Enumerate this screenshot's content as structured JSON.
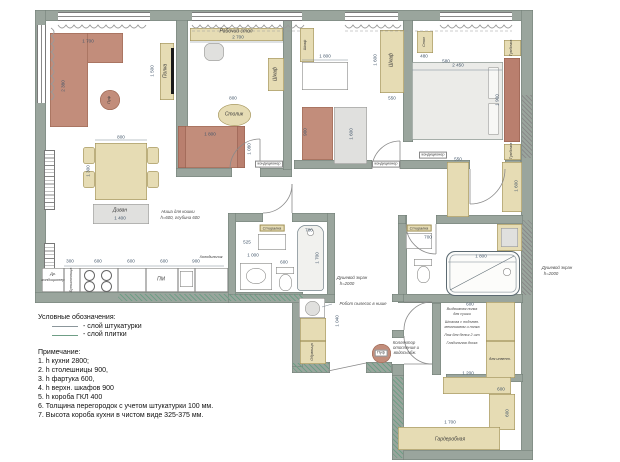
{
  "legend": {
    "title": "Условные обозначения:",
    "items": [
      {
        "swatch": "plaster",
        "label": "- слой штукатурки"
      },
      {
        "swatch": "tile",
        "label": "- слой плитки"
      }
    ]
  },
  "notes": {
    "title": "Примечание:",
    "items": [
      "1. h кухни 2800;",
      "2. h столешницы 900,",
      "3. h фартука 600,",
      "4. h верхн. шкафов 900",
      "5. h короба ГКЛ 400",
      "6. Толщина перегородок с учетом штукатурки 100 мм.",
      "7. Высота короба кухни в чистом виде 325-375 мм."
    ]
  },
  "colors": {
    "wall": "#9aa59d",
    "accent_red": "#c28d7b",
    "furniture_beige": "#e6dcb4",
    "tile_hatch": "#6f9e86"
  },
  "plan": {
    "labels": [
      {
        "text": "Рабочий стол",
        "x": 236,
        "y": 32,
        "cls": "name"
      },
      {
        "text": "2 700",
        "x": 238,
        "y": 38,
        "cls": "dim"
      },
      {
        "text": "Полка",
        "x": 166,
        "y": 71,
        "rot": 1,
        "cls": "name"
      },
      {
        "text": "1 500",
        "x": 153,
        "y": 71,
        "rot": 1,
        "cls": "dim"
      },
      {
        "text": "Шкаф",
        "x": 276,
        "y": 74,
        "rot": 1,
        "cls": "name"
      },
      {
        "text": "1 080",
        "x": 250,
        "y": 149,
        "rot": 1,
        "cls": "dim"
      },
      {
        "text": "Столик",
        "x": 234,
        "y": 115,
        "cls": "name"
      },
      {
        "text": "800",
        "x": 233,
        "y": 99,
        "cls": "dim"
      },
      {
        "text": "1 800",
        "x": 210,
        "y": 135,
        "cls": "dim"
      },
      {
        "text": "1 700",
        "x": 88,
        "y": 42,
        "cls": "dim"
      },
      {
        "text": "2 380",
        "x": 64,
        "y": 86,
        "rot": 1,
        "cls": "dim"
      },
      {
        "text": "Пуф",
        "x": 110,
        "y": 100,
        "rot": 1,
        "cls": "name4"
      },
      {
        "text": "800",
        "x": 121,
        "y": 138,
        "cls": "dim"
      },
      {
        "text": "1 300",
        "x": 89,
        "y": 171,
        "rot": 1,
        "cls": "dim"
      },
      {
        "text": "Диван",
        "x": 120,
        "y": 211,
        "cls": "name"
      },
      {
        "text": "1 400",
        "x": 120,
        "y": 219,
        "cls": "dim"
      },
      {
        "text": "Ниша для кошки",
        "x": 178,
        "y": 212,
        "cls": "note"
      },
      {
        "text": "h=600, глубина 600",
        "x": 180,
        "y": 218,
        "cls": "note"
      },
      {
        "text": "Др.",
        "x": 53,
        "y": 275,
        "cls": "name4"
      },
      {
        "text": "кондиционер",
        "x": 53,
        "y": 281,
        "cls": "name4"
      },
      {
        "text": "Бутылочница",
        "x": 72,
        "y": 280,
        "rot": 1,
        "cls": "name4"
      },
      {
        "text": "ПМ",
        "x": 161,
        "y": 280,
        "cls": "name"
      },
      {
        "text": "Холодильник",
        "x": 211,
        "y": 258,
        "cls": "name4"
      },
      {
        "text": "300",
        "x": 70,
        "y": 262,
        "cls": "dim"
      },
      {
        "text": "600",
        "x": 98,
        "y": 262,
        "cls": "dim"
      },
      {
        "text": "600",
        "x": 131,
        "y": 262,
        "cls": "dim"
      },
      {
        "text": "600",
        "x": 164,
        "y": 262,
        "cls": "dim"
      },
      {
        "text": "900",
        "x": 196,
        "y": 262,
        "cls": "dim"
      },
      {
        "text": "Шкаф",
        "x": 306,
        "y": 45,
        "rot": 1,
        "cls": "name4"
      },
      {
        "text": "1 800",
        "x": 325,
        "y": 57,
        "cls": "dim"
      },
      {
        "text": "900",
        "x": 306,
        "y": 132,
        "rot": 1,
        "cls": "dim"
      },
      {
        "text": "1 600",
        "x": 352,
        "y": 134,
        "rot": 1,
        "cls": "dim"
      },
      {
        "text": "Шкаф",
        "x": 392,
        "y": 60,
        "rot": 1,
        "cls": "name"
      },
      {
        "text": "1 600",
        "x": 376,
        "y": 60,
        "rot": 1,
        "cls": "dim"
      },
      {
        "text": "550",
        "x": 392,
        "y": 99,
        "cls": "dim"
      },
      {
        "text": "Стол",
        "x": 425,
        "y": 42,
        "rot": 1,
        "cls": "name4"
      },
      {
        "text": "480",
        "x": 424,
        "y": 57,
        "cls": "dim"
      },
      {
        "text": "580",
        "x": 446,
        "y": 62,
        "cls": "dim"
      },
      {
        "text": "2 450",
        "x": 458,
        "y": 66,
        "cls": "dim"
      },
      {
        "text": "1 900",
        "x": 498,
        "y": 100,
        "rot": 1,
        "cls": "dim"
      },
      {
        "text": "Тумбочка",
        "x": 512,
        "y": 48,
        "rot": 1,
        "cls": "name4"
      },
      {
        "text": "Тумбочка",
        "x": 512,
        "y": 151,
        "rot": 1,
        "cls": "name4"
      },
      {
        "text": "кондиционер",
        "x": 269,
        "y": 164,
        "cls": "box"
      },
      {
        "text": "кондиционер",
        "x": 386,
        "y": 164,
        "cls": "box"
      },
      {
        "text": "кондиционер",
        "x": 433,
        "y": 155,
        "cls": "box"
      },
      {
        "text": "550",
        "x": 458,
        "y": 160,
        "cls": "dim"
      },
      {
        "text": "1 600",
        "x": 517,
        "y": 186,
        "rot": 1,
        "cls": "dim"
      },
      {
        "text": "Стиралка",
        "x": 272,
        "y": 228,
        "cls": "namebox"
      },
      {
        "text": "525",
        "x": 247,
        "y": 243,
        "cls": "dim"
      },
      {
        "text": "1 000",
        "x": 253,
        "y": 256,
        "cls": "dim"
      },
      {
        "text": "600",
        "x": 284,
        "y": 263,
        "cls": "dim"
      },
      {
        "text": "700",
        "x": 309,
        "y": 231,
        "cls": "dim"
      },
      {
        "text": "1 700",
        "x": 318,
        "y": 258,
        "rot": 1,
        "cls": "dim"
      },
      {
        "text": "Душевой экран",
        "x": 352,
        "y": 278,
        "cls": "note"
      },
      {
        "text": "h=2000",
        "x": 347,
        "y": 284,
        "cls": "note"
      },
      {
        "text": "Стиралка",
        "x": 419,
        "y": 228,
        "cls": "namebox"
      },
      {
        "text": "700",
        "x": 428,
        "y": 238,
        "cls": "dim"
      },
      {
        "text": "1 800",
        "x": 481,
        "y": 257,
        "cls": "dim"
      },
      {
        "text": "Душевой экран",
        "x": 557,
        "y": 268,
        "cls": "note"
      },
      {
        "text": "h=2000",
        "x": 551,
        "y": 274,
        "cls": "note"
      },
      {
        "text": "Робот пылесос в нише",
        "x": 363,
        "y": 304,
        "cls": "note"
      },
      {
        "text": "1 040",
        "x": 338,
        "y": 321,
        "rot": 1,
        "cls": "dim"
      },
      {
        "text": "Обувница",
        "x": 313,
        "y": 352,
        "rot": 1,
        "cls": "name4"
      },
      {
        "text": "Пуф",
        "x": 381,
        "y": 353,
        "cls": "box"
      },
      {
        "text": "Коллектор",
        "x": 404,
        "y": 343,
        "cls": "note"
      },
      {
        "text": "отопления и",
        "x": 406,
        "y": 348,
        "cls": "note"
      },
      {
        "text": "водоснабж.",
        "x": 405,
        "y": 353,
        "cls": "note"
      },
      {
        "text": "600",
        "x": 470,
        "y": 305,
        "cls": "dim"
      },
      {
        "text": "Выдвижная полка",
        "x": 462,
        "y": 310,
        "cls": "note4"
      },
      {
        "text": "для сушки",
        "x": 462,
        "y": 315,
        "cls": "note4"
      },
      {
        "text": "Штанга с подъемн.",
        "x": 462,
        "y": 323,
        "cls": "note4"
      },
      {
        "text": "механизмом и полка",
        "x": 462,
        "y": 328,
        "cls": "note4"
      },
      {
        "text": "Люк для белья 2 шт",
        "x": 462,
        "y": 336,
        "cls": "note4"
      },
      {
        "text": "Гладильная доска",
        "x": 462,
        "y": 344,
        "cls": "note4"
      },
      {
        "text": "для инвент.",
        "x": 500,
        "y": 360,
        "cls": "name4"
      },
      {
        "text": "1 200",
        "x": 468,
        "y": 374,
        "cls": "dim"
      },
      {
        "text": "600",
        "x": 501,
        "y": 390,
        "cls": "dim"
      },
      {
        "text": "600",
        "x": 508,
        "y": 413,
        "rot": 1,
        "cls": "dim"
      },
      {
        "text": "1 700",
        "x": 450,
        "y": 423,
        "cls": "dim"
      },
      {
        "text": "Гардеробная",
        "x": 450,
        "y": 440,
        "cls": "name"
      }
    ]
  }
}
